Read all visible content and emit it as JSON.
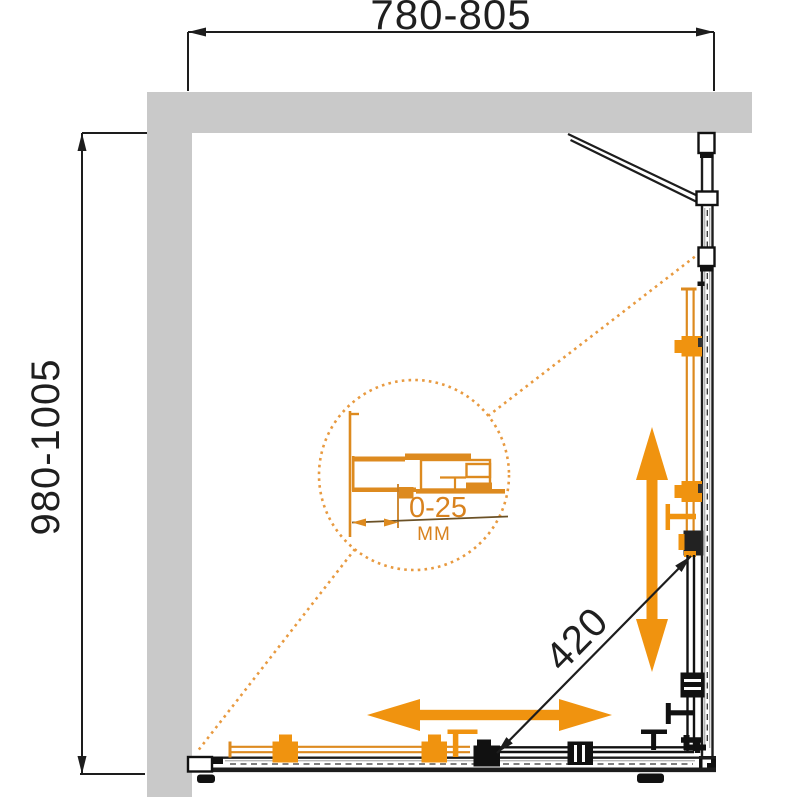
{
  "diagram": {
    "type": "shower-enclosure-dimension-drawing",
    "width_label": "780-805",
    "depth_label": "980-1005",
    "entry_label": "420",
    "detail": {
      "value": "0-25",
      "unit": "MM"
    },
    "colors": {
      "accent_orange": "#F0930F",
      "detail_orange": "#DD8A1F",
      "leader_orange": "#E89A40",
      "wall_gray": "#C9C9C9",
      "line_black": "#1D1D1D"
    }
  }
}
